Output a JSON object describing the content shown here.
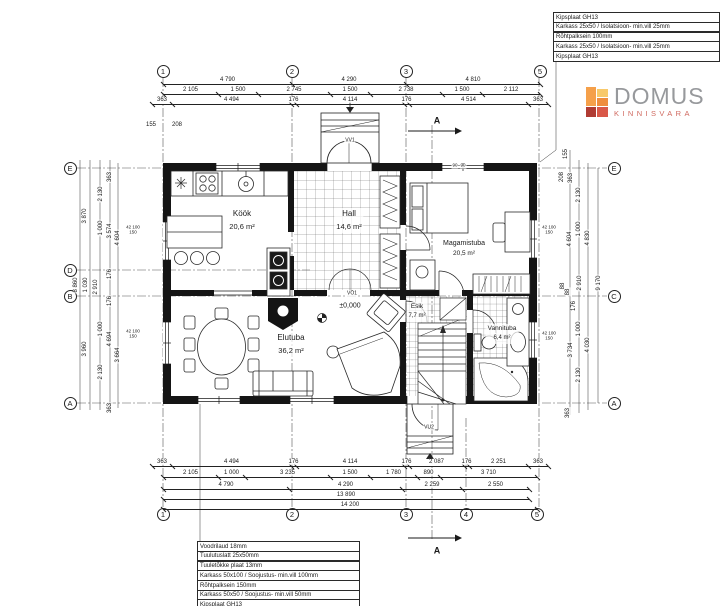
{
  "logo": {
    "title": "DOMUS",
    "subtitle": "KINNISVARA",
    "mark_colors": [
      "#f5a04a",
      "#b03b33",
      "#f8c96a",
      "#ef8d3d",
      "#d95848"
    ]
  },
  "legend_top_right": {
    "rows": [
      "Kipsplaat GH13",
      "Karkass 25x50 / Isolatsioon- min.vill 25mm",
      "Rõhtpalksein 100mm",
      "Karkass 25x50 / Isolatsioon- min.vill 25mm",
      "Kipsplaat GH13"
    ]
  },
  "legend_bottom_left": {
    "rows": [
      "Voodrilaud 18mm",
      "Tuulutuslatt 25x50mm",
      "Tuuletõkke plaat 13mm",
      "Karkass 50x100 / Soojustus- min.vill 100mm",
      "Rõhtpalksein 150mm",
      "Karkass 50x50 / Soojustus- min.vill 50mm",
      "Kipsplaat GH13"
    ]
  },
  "rooms": [
    {
      "name": "Köök",
      "area": "20,6 m²",
      "x": 242,
      "y": 208,
      "s": 8
    },
    {
      "name": "Hall",
      "area": "14,6 m²",
      "x": 349,
      "y": 208,
      "s": 8
    },
    {
      "name": "Magamistuba",
      "area": "20,5 m²",
      "x": 464,
      "y": 238,
      "s": 7
    },
    {
      "name": "Elutuba",
      "area": "36,2 m²",
      "x": 291,
      "y": 332,
      "s": 8
    },
    {
      "name": "Esik",
      "area": "7,7 m²",
      "x": 417,
      "y": 302,
      "s": 6.5
    },
    {
      "name": "Vannituba",
      "area": "6,4 m²",
      "x": 502,
      "y": 324,
      "s": 6.5
    }
  ],
  "grid_bubbles": [
    {
      "t": "1",
      "x": 163,
      "y": 71
    },
    {
      "t": "2",
      "x": 292,
      "y": 71
    },
    {
      "t": "3",
      "x": 406,
      "y": 71
    },
    {
      "t": "5",
      "x": 540,
      "y": 71
    },
    {
      "t": "1",
      "x": 163,
      "y": 514
    },
    {
      "t": "2",
      "x": 292,
      "y": 514
    },
    {
      "t": "3",
      "x": 406,
      "y": 514
    },
    {
      "t": "4",
      "x": 466,
      "y": 514
    },
    {
      "t": "5",
      "x": 537,
      "y": 514
    },
    {
      "t": "E",
      "x": 70,
      "y": 168
    },
    {
      "t": "D",
      "x": 70,
      "y": 270
    },
    {
      "t": "B",
      "x": 70,
      "y": 296
    },
    {
      "t": "A",
      "x": 70,
      "y": 403
    },
    {
      "t": "E",
      "x": 614,
      "y": 168
    },
    {
      "t": "C",
      "x": 614,
      "y": 296
    },
    {
      "t": "A",
      "x": 614,
      "y": 403
    }
  ],
  "dim_chains": [
    {
      "o": "h",
      "y": 84,
      "b": [
        163,
        292,
        406,
        540
      ],
      "l": [
        "4 790",
        "4 290",
        "4 810"
      ]
    },
    {
      "o": "h",
      "y": 94,
      "b": [
        163,
        218,
        258,
        330,
        370,
        442,
        482,
        540
      ],
      "l": [
        "2 105",
        "1 500",
        "2 745",
        "1 500",
        "2 738",
        "1 500",
        "2 112"
      ]
    },
    {
      "o": "h",
      "y": 104,
      "b": [
        152,
        172,
        291,
        296,
        404,
        409,
        528,
        548
      ],
      "l": [
        "363",
        "4 494",
        "176",
        "4 114",
        "176",
        "4 514",
        "363"
      ]
    },
    {
      "o": "h",
      "y": 466,
      "b": [
        152,
        172,
        291,
        296,
        404,
        409,
        464,
        469,
        528,
        548
      ],
      "l": [
        "363",
        "4 494",
        "176",
        "4 114",
        "176",
        "2 087",
        "176",
        "2 251",
        "363"
      ]
    },
    {
      "o": "h",
      "y": 477,
      "b": [
        163,
        218,
        245,
        330,
        370,
        417,
        440,
        537
      ],
      "l": [
        "2 105",
        "1 000",
        "3 235",
        "1 500",
        "1 780",
        "890",
        "3 710"
      ]
    },
    {
      "o": "h",
      "y": 489,
      "b": [
        163,
        289,
        402,
        462,
        529
      ],
      "l": [
        "4 790",
        "4 290",
        "2 259",
        "2 550"
      ]
    },
    {
      "o": "h",
      "y": 499,
      "b": [
        163,
        529
      ],
      "l": [
        "13 890"
      ]
    },
    {
      "o": "h",
      "y": 509,
      "b": [
        163,
        537
      ],
      "l": [
        "14 200"
      ]
    }
  ],
  "labels": [
    {
      "t": "155",
      "x": 151,
      "y": 125
    },
    {
      "t": "208",
      "x": 177,
      "y": 125
    },
    {
      "t": "363",
      "x": 110,
      "y": 177,
      "r": 1
    },
    {
      "t": "2 130",
      "x": 101,
      "y": 194,
      "r": 1
    },
    {
      "t": "3 870",
      "x": 85,
      "y": 216,
      "r": 1
    },
    {
      "t": "1 000",
      "x": 101,
      "y": 228,
      "r": 1
    },
    {
      "t": "3 574",
      "x": 110,
      "y": 231,
      "r": 1
    },
    {
      "t": "4 604",
      "x": 118,
      "y": 238,
      "r": 1
    },
    {
      "t": "176",
      "x": 110,
      "y": 274,
      "r": 1
    },
    {
      "t": "8 860",
      "x": 76,
      "y": 285,
      "r": 1
    },
    {
      "t": "1 030",
      "x": 86,
      "y": 285,
      "r": 1
    },
    {
      "t": "2 910",
      "x": 96,
      "y": 287,
      "r": 1
    },
    {
      "t": "176",
      "x": 110,
      "y": 301,
      "r": 1
    },
    {
      "t": "1 000",
      "x": 101,
      "y": 329,
      "r": 1
    },
    {
      "t": "4 694",
      "x": 110,
      "y": 339,
      "r": 1
    },
    {
      "t": "3 664",
      "x": 118,
      "y": 355,
      "r": 1
    },
    {
      "t": "3 960",
      "x": 85,
      "y": 349,
      "r": 1
    },
    {
      "t": "2 130",
      "x": 101,
      "y": 372,
      "r": 1
    },
    {
      "t": "363",
      "x": 110,
      "y": 408,
      "r": 1
    },
    {
      "t": "155",
      "x": 566,
      "y": 154,
      "r": 1
    },
    {
      "t": "208",
      "x": 562,
      "y": 177,
      "r": 1
    },
    {
      "t": "363",
      "x": 571,
      "y": 178,
      "r": 1
    },
    {
      "t": "2 130",
      "x": 579,
      "y": 195,
      "r": 1
    },
    {
      "t": "1 000",
      "x": 579,
      "y": 229,
      "r": 1
    },
    {
      "t": "4 604",
      "x": 570,
      "y": 239,
      "r": 1
    },
    {
      "t": "4 830",
      "x": 588,
      "y": 238,
      "r": 1
    },
    {
      "t": "88",
      "x": 563,
      "y": 286,
      "r": 1
    },
    {
      "t": "88",
      "x": 568,
      "y": 292,
      "r": 1
    },
    {
      "t": "2 910",
      "x": 580,
      "y": 283,
      "r": 1
    },
    {
      "t": "9 170",
      "x": 599,
      "y": 283,
      "r": 1
    },
    {
      "t": "176",
      "x": 574,
      "y": 306,
      "r": 1
    },
    {
      "t": "1 000",
      "x": 579,
      "y": 329,
      "r": 1
    },
    {
      "t": "4 030",
      "x": 588,
      "y": 345,
      "r": 1
    },
    {
      "t": "3 734",
      "x": 571,
      "y": 350,
      "r": 1
    },
    {
      "t": "2 130",
      "x": 579,
      "y": 375,
      "r": 1
    },
    {
      "t": "363",
      "x": 568,
      "y": 413,
      "r": 1
    },
    {
      "t": "42 100\n150",
      "x": 133,
      "y": 230,
      "s": 4.5
    },
    {
      "t": "42 100\n150",
      "x": 133,
      "y": 334,
      "s": 4.5
    },
    {
      "t": "42 100\n150",
      "x": 549,
      "y": 230,
      "s": 4.5
    },
    {
      "t": "42 100\n150",
      "x": 549,
      "y": 336,
      "s": 4.5
    },
    {
      "t": "90",
      "x": 455,
      "y": 166,
      "s": 4.5
    },
    {
      "t": "90",
      "x": 463,
      "y": 166,
      "s": 4.5
    },
    {
      "t": "±0,000",
      "x": 350,
      "y": 306,
      "s": 7,
      "n": "level-marker-label"
    },
    {
      "t": "VV1",
      "x": 350,
      "y": 141,
      "s": 5,
      "n": "door-label-vv1"
    },
    {
      "t": "VÖ1",
      "x": 352,
      "y": 294,
      "s": 5,
      "n": "door-label-vo1"
    },
    {
      "t": "VU2",
      "x": 429,
      "y": 428,
      "s": 5,
      "n": "door-label-vu2"
    },
    {
      "t": "A",
      "x": 437,
      "y": 121,
      "s": 9,
      "b": 1,
      "n": "section-marker-a-top"
    },
    {
      "t": "A",
      "x": 437,
      "y": 551,
      "s": 9,
      "b": 1,
      "n": "section-marker-a-bottom"
    }
  ]
}
